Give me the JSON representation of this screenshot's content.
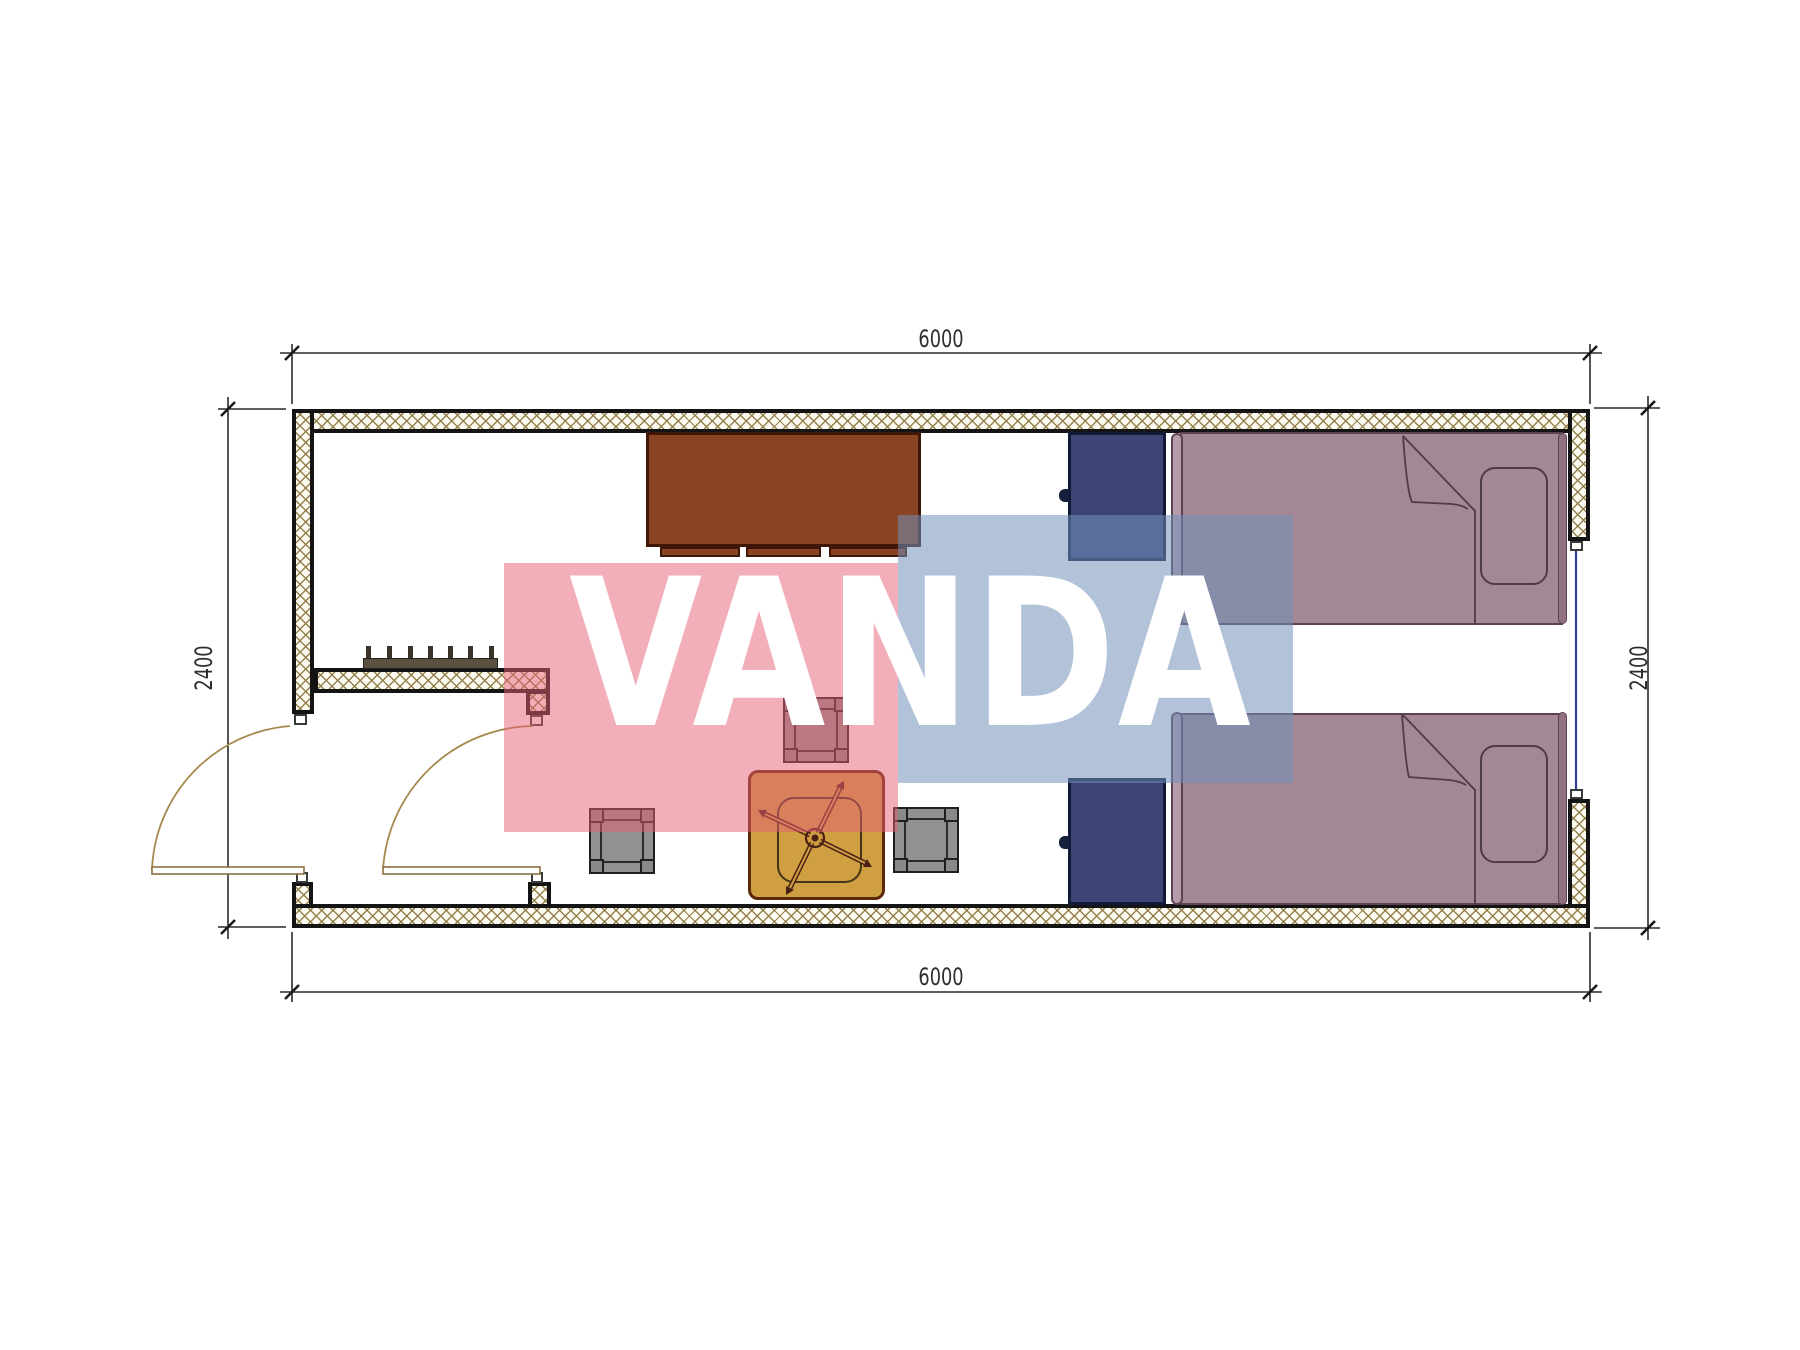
{
  "canvas": {
    "width": 1800,
    "height": 1350,
    "background": "#ffffff"
  },
  "watermark": {
    "text": "VANDA",
    "pink_color": "#e56076",
    "pink_opacity": 0.5,
    "blue_color": "#718fb9",
    "blue_opacity": 0.55,
    "text_color": "#ffffff"
  },
  "dimensions": {
    "top": {
      "label": "6000"
    },
    "bottom": {
      "label": "6000"
    },
    "left": {
      "label": "2400"
    },
    "right": {
      "label": "2400"
    }
  },
  "palette": {
    "wall_hatch_line": "#8f7c45",
    "wall_outline": "#141414",
    "cabinet_brown": "#8a4423",
    "nightstand_navy": "#3c4573",
    "bed_mauve": "#a38796",
    "stool_gray": "#919191",
    "table_amber": "#cf9f41",
    "door_arc_tan": "#a58a4f",
    "window_blue": "#2e3e9a",
    "dimension_line": "#2a2a2a"
  }
}
